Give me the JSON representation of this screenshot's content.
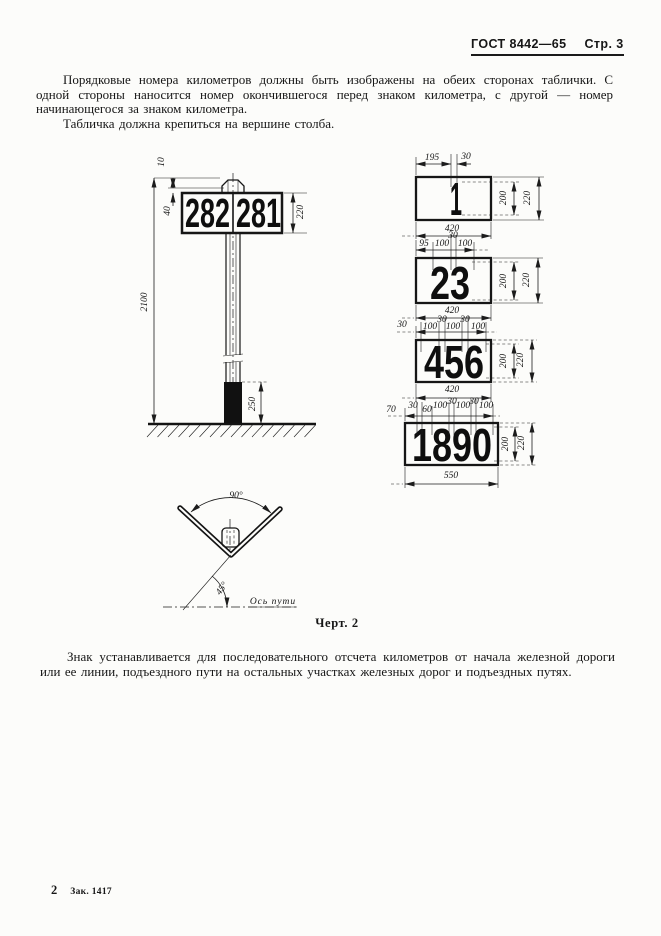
{
  "header": {
    "gost": "ГОСТ 8442—65",
    "page": "Стр. 3"
  },
  "paragraphs": {
    "p1": "Порядковые номера километров должны быть изображены на обеих сторонах таблички. С одной стороны наносится номер окончившегося перед знаком километра, с другой — номер начинающегося за знаком километра.",
    "p2": "Табличка должна крепиться на вершине столба.",
    "p3": "Знак устанавливается для последовательного отсчета километров от начала железной дороги или ее линии, подъездного пути на остальных участках железных дорог и подъездных путях."
  },
  "figure": {
    "caption": "Черт. 2"
  },
  "pfooter": {
    "sheet": "2",
    "order": "Зак. 1417"
  },
  "drawing": {
    "post": {
      "sign_left": "282",
      "sign_right": "281",
      "dims": {
        "top_gap": "10",
        "cap_gap": "40",
        "sign_height": "220",
        "total_height": "2100",
        "base_depth": "250"
      }
    },
    "plates": [
      {
        "number": "1",
        "top_dims": [
          "195",
          "30"
        ],
        "digit_height": "200",
        "plate_height": "220",
        "plate_width": "420"
      },
      {
        "number": "23",
        "top_dims": [
          "95",
          "100",
          "30",
          "100"
        ],
        "digit_height": "200",
        "plate_height": "220",
        "plate_width": "420"
      },
      {
        "number": "456",
        "top_dims": [
          "30",
          "100",
          "30",
          "100",
          "30",
          "100"
        ],
        "digit_height": "200",
        "plate_height": "220",
        "plate_width": "420"
      },
      {
        "number": "1890",
        "top_dims": [
          "70",
          "30",
          "60",
          "100",
          "30",
          "100",
          "30",
          "100"
        ],
        "digit_height": "200",
        "plate_height": "220",
        "plate_width": "550"
      }
    ],
    "bracket": {
      "top_angle": "90°",
      "track_angle": "45°",
      "axis_label": "Ось пути"
    }
  }
}
